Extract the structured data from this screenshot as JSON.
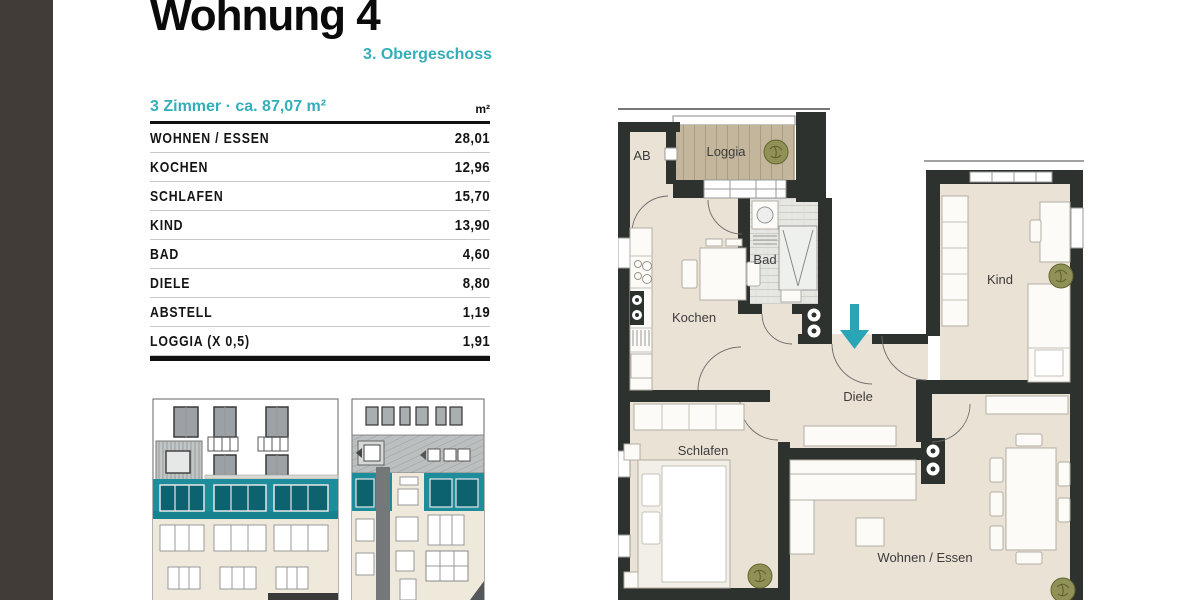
{
  "palette": {
    "accent": "#35aeba",
    "wall": "#2e322f",
    "floor": "#eae2d4",
    "loggia": "#c4b69d",
    "tile": "#e6e6e3",
    "ebeige": "#efe9dc",
    "eteal": "#1d8d9c",
    "etealdark": "#0d626f",
    "roof": "#bcbfbf",
    "plant": "#8f9156",
    "arrow": "#2aa5b5",
    "sidebar": "#413c38"
  },
  "header": {
    "title": "Wohnung 4",
    "subtitle": "3. Obergeschoss"
  },
  "table": {
    "header_left": "3 Zimmer · ca. 87,07 m²",
    "header_right": "m²",
    "rows": [
      {
        "label": "WOHNEN / ESSEN",
        "value": "28,01"
      },
      {
        "label": "KOCHEN",
        "value": "12,96"
      },
      {
        "label": "SCHLAFEN",
        "value": "15,70"
      },
      {
        "label": "KIND",
        "value": "13,90"
      },
      {
        "label": "BAD",
        "value": "4,60"
      },
      {
        "label": "DIELE",
        "value": "8,80"
      },
      {
        "label": "ABSTELL",
        "value": "1,19"
      },
      {
        "label": "LOGGIA (X 0,5)",
        "value": "1,91"
      }
    ]
  },
  "floorplan": {
    "rooms": {
      "ab": "AB",
      "loggia": "Loggia",
      "bad": "Bad",
      "kochen": "Kochen",
      "kind": "Kind",
      "diele": "Diele",
      "schlafen": "Schlafen",
      "wohnen": "Wohnen / Essen"
    }
  }
}
